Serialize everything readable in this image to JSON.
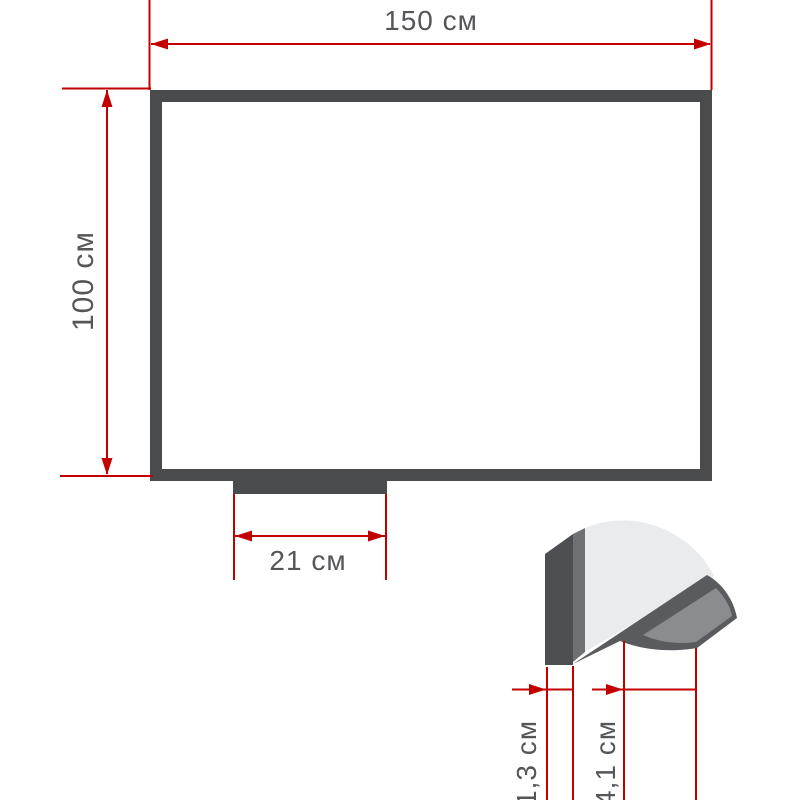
{
  "diagram": {
    "kind": "technical-dimension-drawing",
    "subject": "whiteboard with marker tray: front view and edge profile detail",
    "units_suffix": "см",
    "dimensions": {
      "width_label": "150 см",
      "height_label": "100 см",
      "tray_width_label": "21 см",
      "profile_thickness_label": "1,3 см",
      "tray_depth_label": "4,1 см"
    },
    "colors": {
      "dimension_line": "#c30000",
      "frame": "#4a4b4d",
      "frame_edge": "#707174",
      "surface_light": "#e9ebed",
      "tray_surface": "#8a8c8f",
      "label_text": "#545659",
      "background": "#ffffff"
    }
  }
}
